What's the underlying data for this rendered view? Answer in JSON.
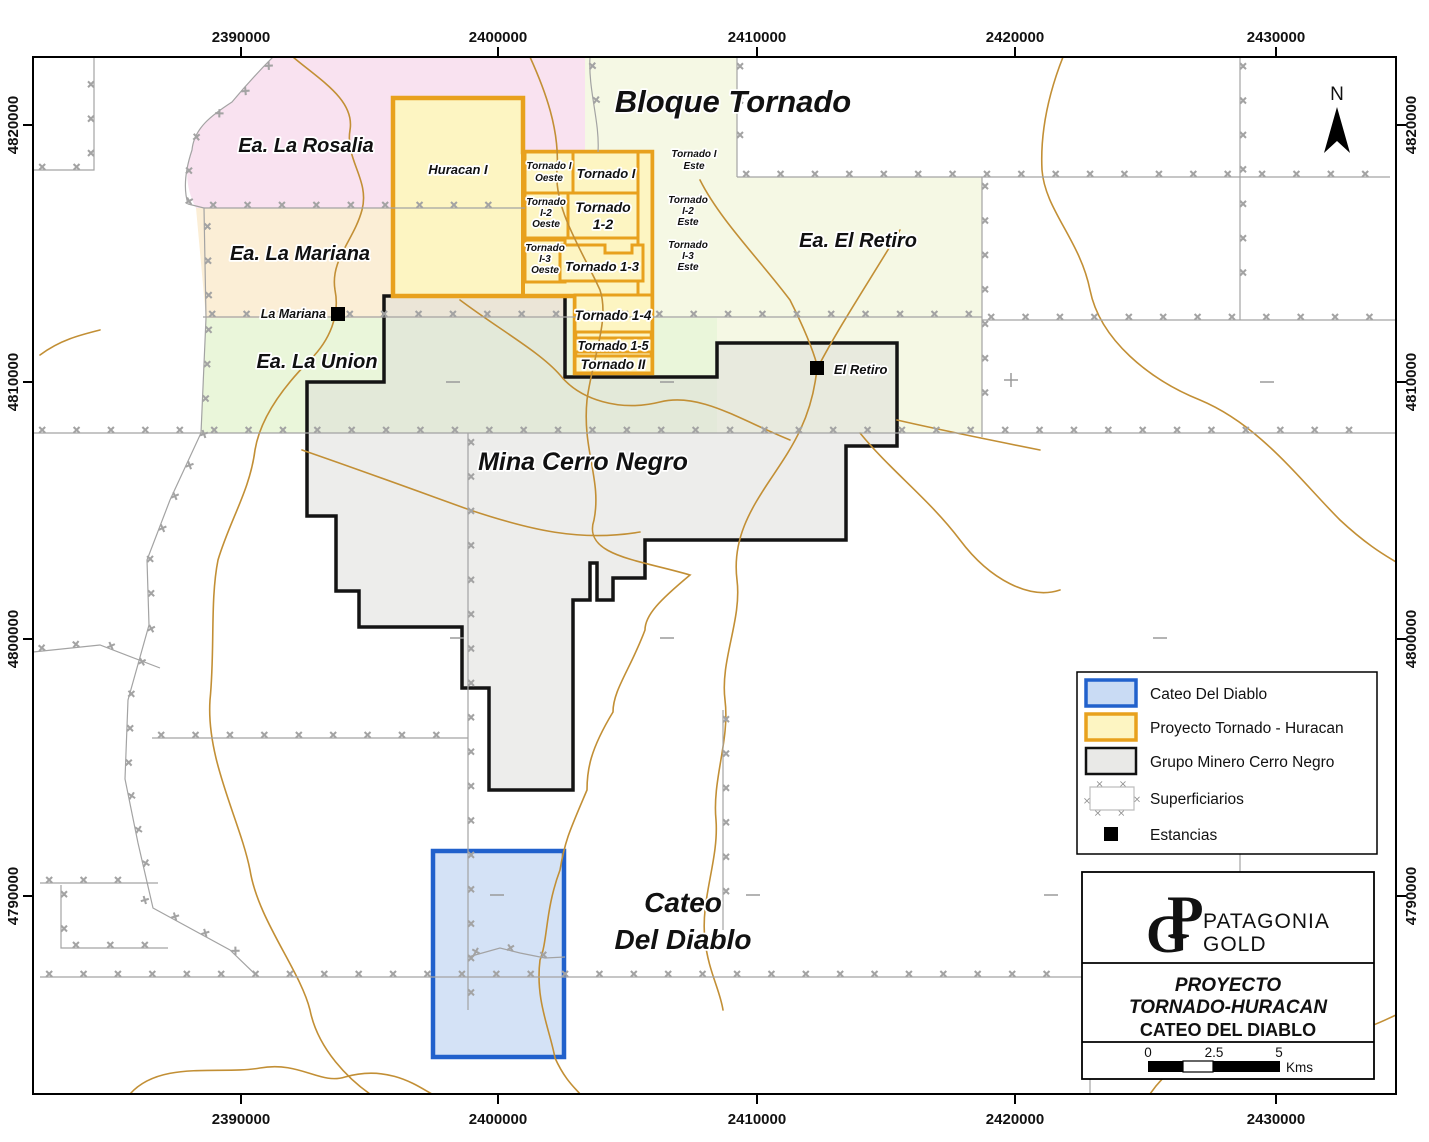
{
  "map_titles": {
    "bloque": "Bloque Tornado",
    "cerro": "Mina Cerro Negro",
    "cateo1": "Cateo",
    "cateo2": "Del Diablo"
  },
  "estancias": {
    "rosalia": "Ea. La Rosalia",
    "mariana": "Ea. La Mariana",
    "union": "Ea. La Union",
    "retiro": "Ea. El Retiro"
  },
  "points": {
    "la_mariana": "La Mariana",
    "el_retiro": "El Retiro"
  },
  "claims": {
    "huracan": "Huracan I",
    "t1o": [
      "Tornado I",
      "Oeste"
    ],
    "t1": "Tornado I",
    "t1e": [
      "Tornado I",
      "Este"
    ],
    "t12o": [
      "Tornado",
      "I-2",
      "Oeste"
    ],
    "t12": [
      "Tornado",
      "1-2"
    ],
    "t12e": [
      "Tornado",
      "I-2",
      "Este"
    ],
    "t13o": [
      "Tornado",
      "I-3",
      "Oeste"
    ],
    "t13": "Tornado 1-3",
    "t13e": [
      "Tornado",
      "I-3",
      "Este"
    ],
    "t14": "Tornado 1-4",
    "t15": "Tornado 1-5",
    "t2": "Tornado II"
  },
  "axes": {
    "x": [
      "2390000",
      "2400000",
      "2410000",
      "2420000",
      "2430000"
    ],
    "y": [
      "4820000",
      "4810000",
      "4800000",
      "4790000"
    ]
  },
  "north_label": "N",
  "legend": {
    "items": [
      "Cateo Del Diablo",
      "Proyecto Tornado - Huracan",
      "Grupo Minero Cerro Negro",
      "Superficiarios",
      "Estancias"
    ]
  },
  "title_block": {
    "brand_p": "P",
    "brand_g": "G",
    "brand_name1": "PATAGONIA",
    "brand_name2": "GOLD",
    "line1": "PROYECTO",
    "line2": "TORNADO-HURACAN",
    "line3": "CATEO DEL DIABLO",
    "scale_ticks": [
      "0",
      "2.5",
      "5"
    ],
    "scale_unit": "Kms"
  },
  "colors": {
    "proyecto_fill": "#fdf5c2",
    "proyecto_border": "#e8a11d",
    "cateo_fill": "#c9dbf4",
    "cateo_border": "#2161cc",
    "cerro_fill": "#dcdcd8",
    "cerro_border": "#141414",
    "rosalia_fill": "#f9e2f0",
    "mariana_fill": "#fbeed6",
    "union_fill": "#eaf6da",
    "retiro_fill": "#f5f8e4",
    "stream": "#c28f35",
    "superficiario": "#a3a3a3",
    "logo_gold": "#8d7c50"
  }
}
